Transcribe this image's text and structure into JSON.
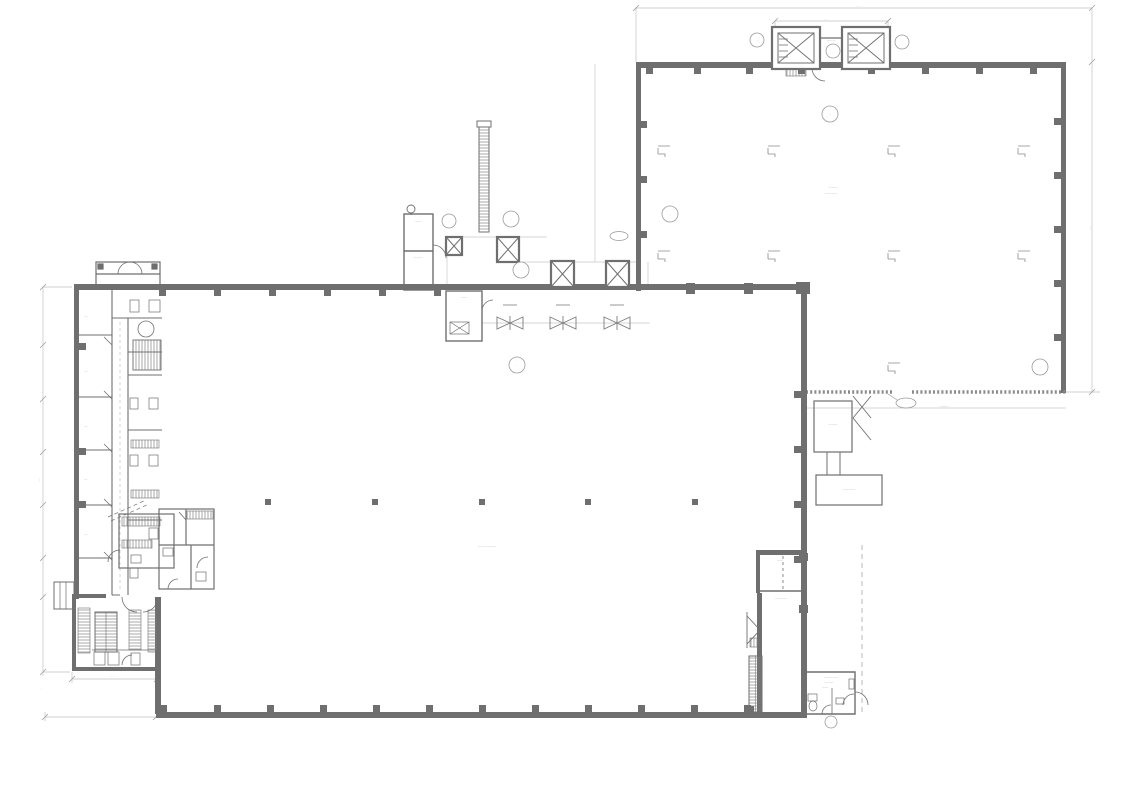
{
  "document": {
    "kind": "architectural-floor-plan",
    "sheet_background": "#ffffff"
  },
  "colors": {
    "wall": "#6f6f6f",
    "wall2": "#8a8a8a",
    "line": "#7d7d7d",
    "thin": "#c6c9ca",
    "dim": "#bfc3c4",
    "hatch": "#828282",
    "text": "#8d9091"
  },
  "tag_glyph": "··",
  "labels": [
    {
      "x": 858,
      "y": 7,
      "t": "····",
      "s": 3
    },
    {
      "x": 826,
      "y": 20,
      "t": "····",
      "s": 3
    },
    {
      "x": 1091,
      "y": 228,
      "t": "····",
      "s": 3,
      "r": -90
    },
    {
      "x": 831,
      "y": 41,
      "t": "———",
      "s": 3
    },
    {
      "x": 833,
      "y": 188,
      "t": "———",
      "s": 3
    },
    {
      "x": 831,
      "y": 194,
      "t": "————",
      "s": 3
    },
    {
      "x": 944,
      "y": 407,
      "t": "———",
      "s": 3
    },
    {
      "x": 418,
      "y": 222,
      "t": "——",
      "s": 3
    },
    {
      "x": 418,
      "y": 258,
      "t": "———",
      "s": 3
    },
    {
      "x": 464,
      "y": 298,
      "t": "——",
      "s": 3
    },
    {
      "x": 487,
      "y": 547,
      "t": "——————",
      "s": 3
    },
    {
      "x": 86,
      "y": 317,
      "t": "—·",
      "s": 3
    },
    {
      "x": 86,
      "y": 372,
      "t": "—·",
      "s": 3
    },
    {
      "x": 86,
      "y": 427,
      "t": "—·",
      "s": 3
    },
    {
      "x": 86,
      "y": 480,
      "t": "—·",
      "s": 3
    },
    {
      "x": 86,
      "y": 535,
      "t": "—·",
      "s": 3
    },
    {
      "x": 833,
      "y": 425,
      "t": "———",
      "s": 3
    },
    {
      "x": 849,
      "y": 490,
      "t": "————",
      "s": 3
    },
    {
      "x": 780,
      "y": 561,
      "t": "——",
      "s": 3
    },
    {
      "x": 781,
      "y": 599,
      "t": "————",
      "s": 3
    },
    {
      "x": 831,
      "y": 678,
      "t": "—————",
      "s": 3
    },
    {
      "x": 829,
      "y": 683,
      "t": "———",
      "s": 3
    },
    {
      "x": 825,
      "y": 688,
      "t": "——",
      "s": 3
    },
    {
      "x": 906,
      "y": 404,
      "t": "··",
      "s": 3
    },
    {
      "x": 40,
      "y": 480,
      "t": "····",
      "s": 3,
      "r": -90
    },
    {
      "x": 42,
      "y": 689,
      "t": "··",
      "s": 3,
      "r": -90
    },
    {
      "x": 112,
      "y": 677,
      "t": "···",
      "s": 3
    }
  ],
  "symbols": {
    "pilasters": [
      [
        646,
        68,
        7,
        6
      ],
      [
        694,
        68,
        7,
        6
      ],
      [
        746,
        68,
        7,
        6
      ],
      [
        798,
        68,
        7,
        6
      ],
      [
        868,
        68,
        7,
        6
      ],
      [
        922,
        68,
        7,
        6
      ],
      [
        976,
        68,
        7,
        6
      ],
      [
        1030,
        68,
        7,
        6
      ],
      [
        641,
        121,
        6,
        7
      ],
      [
        641,
        176,
        6,
        7
      ],
      [
        641,
        231,
        6,
        7
      ],
      [
        1054,
        118,
        7,
        7
      ],
      [
        1054,
        172,
        7,
        7
      ],
      [
        1054,
        226,
        7,
        7
      ],
      [
        1054,
        280,
        7,
        7
      ],
      [
        1054,
        334,
        7,
        7
      ],
      [
        686,
        283,
        9,
        11
      ],
      [
        744,
        283,
        9,
        11
      ],
      [
        796,
        282,
        14,
        12
      ],
      [
        159,
        290,
        7,
        6
      ],
      [
        214,
        290,
        7,
        6
      ],
      [
        269,
        290,
        7,
        6
      ],
      [
        324,
        290,
        7,
        6
      ],
      [
        379,
        290,
        7,
        6
      ],
      [
        434,
        290,
        7,
        6
      ],
      [
        159,
        705,
        8,
        8
      ],
      [
        214,
        705,
        7,
        7
      ],
      [
        267,
        705,
        7,
        7
      ],
      [
        320,
        705,
        7,
        7
      ],
      [
        373,
        705,
        7,
        7
      ],
      [
        426,
        705,
        7,
        7
      ],
      [
        479,
        705,
        7,
        7
      ],
      [
        532,
        705,
        7,
        7
      ],
      [
        585,
        705,
        7,
        7
      ],
      [
        638,
        705,
        7,
        7
      ],
      [
        691,
        705,
        7,
        7
      ],
      [
        744,
        705,
        7,
        7
      ],
      [
        79,
        343,
        7,
        7
      ],
      [
        79,
        448,
        7,
        7
      ],
      [
        79,
        501,
        7,
        7
      ],
      [
        794,
        391,
        7,
        7
      ],
      [
        794,
        446,
        7,
        7
      ],
      [
        794,
        501,
        7,
        7
      ],
      [
        794,
        556,
        7,
        7
      ],
      [
        746,
        706,
        8,
        7
      ],
      [
        799,
        553,
        9,
        8
      ],
      [
        799,
        605,
        9,
        8
      ]
    ],
    "columns": [
      [
        265,
        499
      ],
      [
        372,
        499
      ],
      [
        479,
        499
      ],
      [
        585,
        499
      ],
      [
        692,
        499
      ]
    ],
    "brackets": [
      [
        658,
        146
      ],
      [
        768,
        146
      ],
      [
        888,
        146
      ],
      [
        1018,
        146
      ],
      [
        658,
        251
      ],
      [
        768,
        251
      ],
      [
        888,
        251
      ],
      [
        1018,
        251
      ],
      [
        888,
        363
      ]
    ],
    "bowties": [
      [
        510,
        323
      ],
      [
        563,
        323
      ],
      [
        617,
        323
      ]
    ],
    "dashmarks": [
      [
        503,
        305
      ],
      [
        556,
        305
      ],
      [
        610,
        305
      ]
    ],
    "tags": [
      {
        "x": 757,
        "y": 40,
        "r": 7
      },
      {
        "x": 902,
        "y": 42,
        "r": 7
      },
      {
        "x": 833,
        "y": 51,
        "r": 7
      },
      {
        "x": 830,
        "y": 114,
        "r": 8
      },
      {
        "x": 670,
        "y": 214,
        "r": 8
      },
      {
        "x": 449,
        "y": 221,
        "r": 7
      },
      {
        "x": 511,
        "y": 219,
        "r": 8
      },
      {
        "x": 521,
        "y": 270,
        "r": 8
      },
      {
        "x": 517,
        "y": 365,
        "r": 8
      },
      {
        "x": 1040,
        "y": 367,
        "r": 8
      },
      {
        "x": 831,
        "y": 722,
        "r": 6
      }
    ],
    "shafts": [
      {
        "x": 772,
        "y": 27,
        "w": 48,
        "h": 42,
        "lift": true
      },
      {
        "x": 842,
        "y": 27,
        "w": 48,
        "h": 42,
        "lift": true
      },
      {
        "x": 446,
        "y": 237,
        "w": 16,
        "h": 18
      },
      {
        "x": 497,
        "y": 237,
        "w": 22,
        "h": 25
      },
      {
        "x": 551,
        "y": 261,
        "w": 23,
        "h": 26
      },
      {
        "x": 606,
        "y": 261,
        "w": 23,
        "h": 26
      }
    ],
    "dimticks": [
      [
        636,
        8
      ],
      [
        1092,
        8
      ],
      [
        775,
        21
      ],
      [
        888,
        21
      ],
      [
        1092,
        62
      ],
      [
        1092,
        392
      ],
      [
        43,
        287
      ],
      [
        43,
        345
      ],
      [
        43,
        399
      ],
      [
        43,
        452
      ],
      [
        43,
        505
      ],
      [
        43,
        558
      ],
      [
        43,
        597
      ],
      [
        43,
        672
      ],
      [
        72,
        679
      ],
      [
        157,
        679
      ],
      [
        45,
        717
      ],
      [
        156,
        717
      ]
    ]
  }
}
